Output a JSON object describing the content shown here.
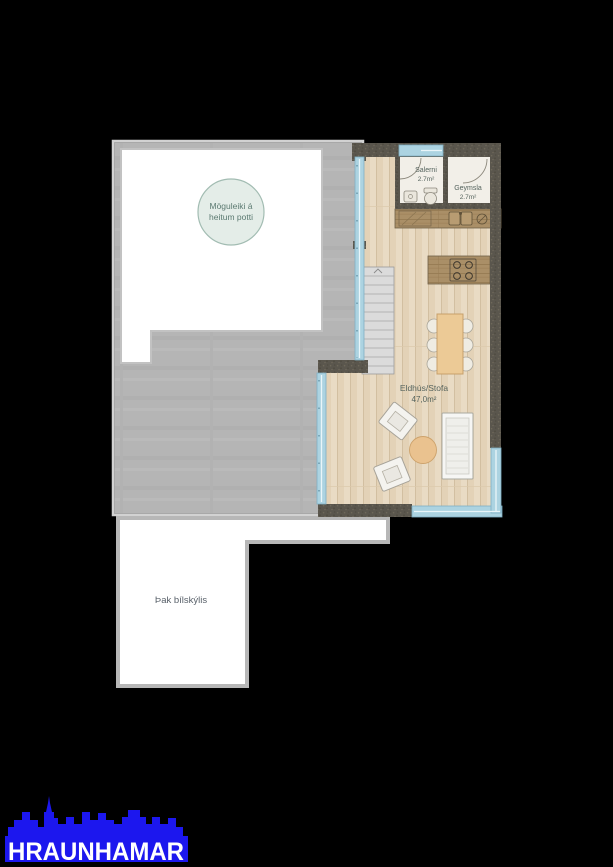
{
  "plan": {
    "hot_tub": {
      "line1": "Möguleiki á",
      "line2": "heitum potti"
    },
    "toilet": {
      "name": "Salerni",
      "area": "2.7m²"
    },
    "storage": {
      "name": "Geymsla",
      "area": "2.7m²"
    },
    "living": {
      "name": "Eldhús/Stofa",
      "area": "47,0m²"
    },
    "carport_roof": {
      "label": "Þak bílskýlis"
    }
  },
  "branding": {
    "logo_text": "HRAUNHAMAR",
    "logo_color": "#1c17ee"
  },
  "colors": {
    "background": "#000000",
    "terrace_concrete": "#b5b5b5",
    "plan_white": "#ffffff",
    "wood_floor": "#e8dac3",
    "cabinet_wood": "#aa8f67",
    "exterior_wall": "#5a564d",
    "window_glass": "#acd3e1",
    "hot_tub_circle_fill": "#e4ede8",
    "accent_text": "#5b7a71",
    "furniture_tan": "#ecca96"
  }
}
